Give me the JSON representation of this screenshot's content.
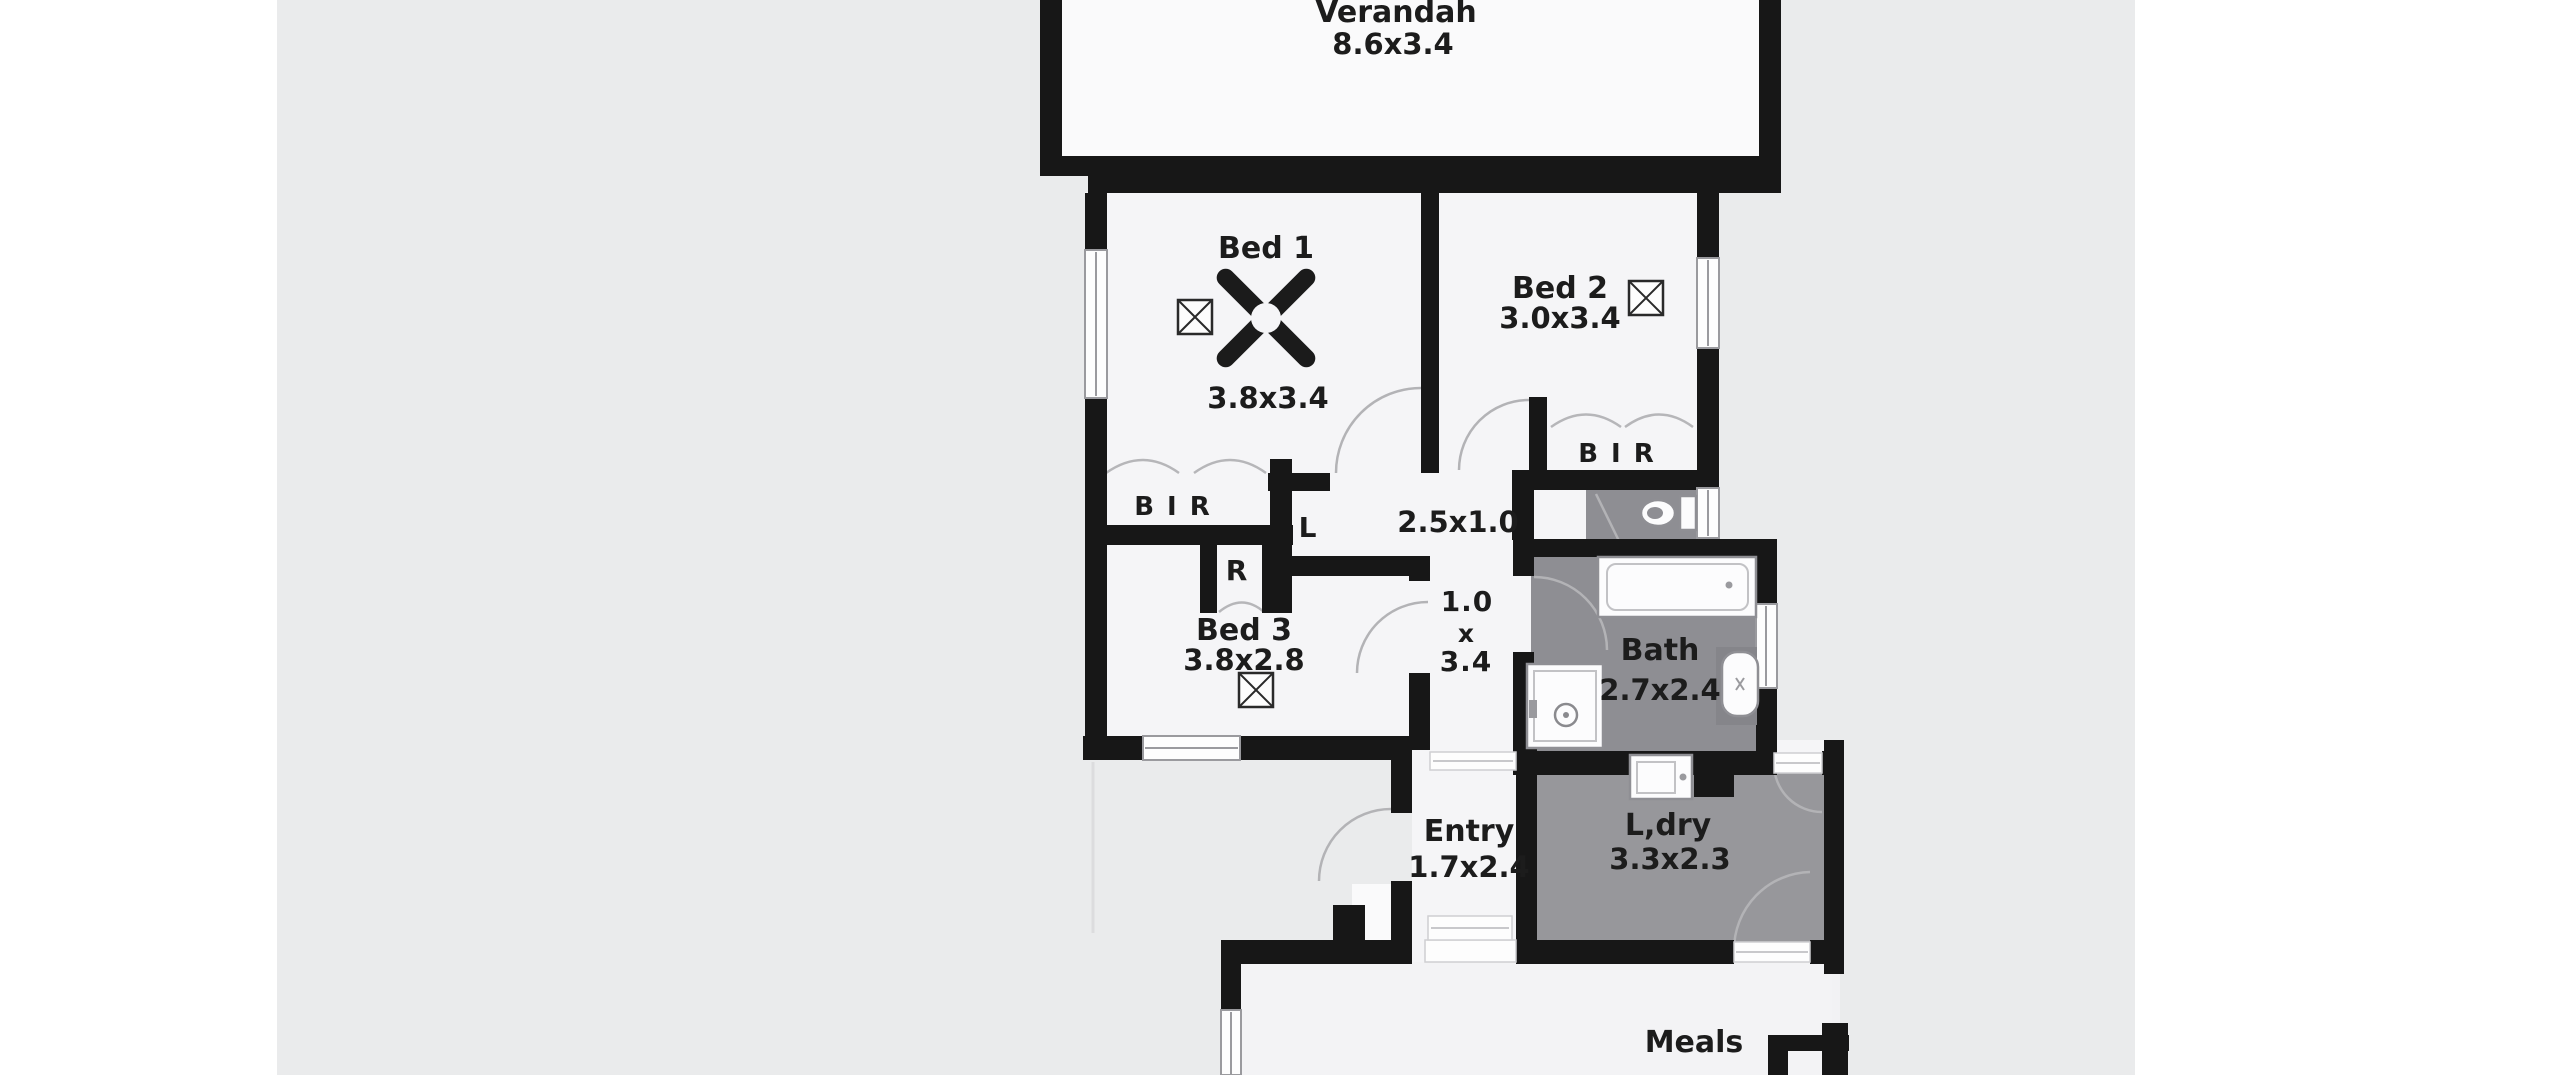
{
  "plan": {
    "type": "residential-floor-plan",
    "rooms": {
      "verandah": {
        "name": "Verandah",
        "dims": "8.6x3.4"
      },
      "bed1": {
        "name": "Bed 1",
        "dims": "3.8x3.4"
      },
      "bed2": {
        "name": "Bed 2",
        "dims": "3.0x3.4"
      },
      "bed3": {
        "name": "Bed 3",
        "dims": "3.8x2.8"
      },
      "bath": {
        "name": "Bath",
        "dims": "2.7x2.4"
      },
      "entry": {
        "name": "Entry",
        "dims": "1.7x2.4"
      },
      "laundry": {
        "name": "L,dry",
        "dims": "3.3x2.3"
      },
      "meals": {
        "name": "Meals"
      },
      "hall_main": {
        "dims": "2.5x1.0"
      },
      "hall_side": {
        "width": "1.0",
        "sep": "x",
        "length": "3.4"
      },
      "bir_bed1": {
        "label": "B I R"
      },
      "bir_bed2": {
        "label": "B I R"
      },
      "robe": {
        "label": "R"
      },
      "linen": {
        "label": "L"
      }
    },
    "colors": {
      "page": "#ffffff",
      "backdrop": "#eaebec",
      "wall": "#171717",
      "room_floor": "#f5f5f7",
      "wet_floor": "#8e8e93",
      "laundry_floor": "#97979b",
      "meals_floor": "#f3f3f5",
      "label_text": "#1c1c1c"
    }
  }
}
